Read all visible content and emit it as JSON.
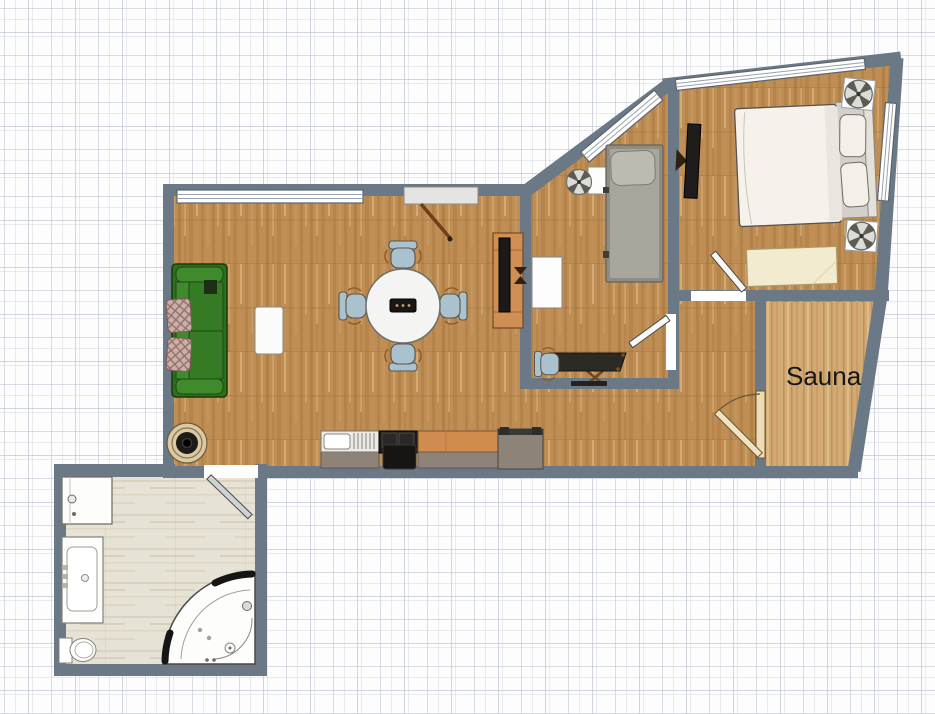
{
  "canvas": {
    "type": "floor-plan-editor",
    "width_px": 935,
    "height_px": 714
  },
  "rooms": {
    "living_room": {
      "label": "",
      "floor": "wood"
    },
    "middle_room": {
      "label": "",
      "floor": "wood"
    },
    "bedroom": {
      "label": "",
      "floor": "wood"
    },
    "hallway": {
      "label": "",
      "floor": "wood"
    },
    "sauna": {
      "label": "Sauna",
      "floor": "light-wood"
    },
    "bathroom": {
      "label": "",
      "floor": "stone-tile"
    }
  },
  "furniture": {
    "living_room": [
      "sofa",
      "throw-pillow",
      "throw-pillow",
      "coffee-table",
      "round-dining-table",
      "dining-chair",
      "dining-chair",
      "dining-chair",
      "dining-chair",
      "tv-cabinet",
      "tv",
      "floor-speaker",
      "kitchen-sink-unit",
      "stove-oven",
      "kitchen-counter",
      "fridge"
    ],
    "middle_room": [
      "single-bed",
      "fan-unit",
      "side-table",
      "wall-table",
      "desk",
      "desk-chair"
    ],
    "bedroom": [
      "double-bed",
      "pillow",
      "pillow",
      "bench",
      "wall-tv",
      "fan-unit",
      "fan-unit"
    ],
    "bathroom": [
      "shower-unit",
      "vanity-sink",
      "toilet",
      "corner-bathtub"
    ]
  },
  "openings": [
    "entry-door",
    "bathroom-door",
    "middle-room-door",
    "bedroom-door",
    "sauna-door",
    "window",
    "window",
    "window",
    "window"
  ],
  "palette": {
    "wall": "#6b7885",
    "window-frame": "#5a6570",
    "wood": "#bf8e55",
    "wood-dark": "#a9783f",
    "wood-light": "#d4a872",
    "sauna-wood": "#d2aa74",
    "bath-floor": "#e7e2d6",
    "sofa": "#357a24",
    "sofa-dark": "#1d4a10",
    "pillow-plaid": "#cbb0a9",
    "chair": "#a9c2cd",
    "cabinet": "#cf8e53",
    "counter-top": "#d08c4e",
    "counter-base": "#8d8378",
    "appliance-dark": "#232120",
    "door-leaf": "#e3e3e1",
    "sauna-door": "#eeddb4",
    "bed-linen": "#f6f1ea",
    "single-bed": "#a8a59d",
    "bench": "#f3ebd0"
  }
}
